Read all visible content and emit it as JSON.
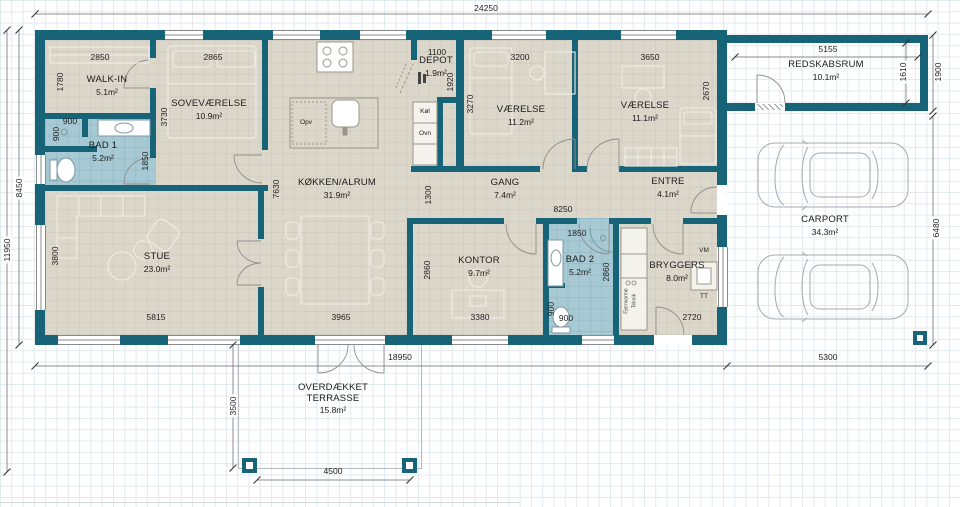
{
  "colors": {
    "wall": "#176478",
    "floor": "#dcd7cb",
    "bathroom_floor": "#a7c9d3",
    "grid": "#e2e9ee",
    "dimension_text": "#1f1f1f"
  },
  "rooms": [
    {
      "name": "WALK-IN",
      "area": "5.1m²",
      "x": 107,
      "y": 86,
      "w": 70
    },
    {
      "name": "SOVEVÆRELSE",
      "area": "10.9m²",
      "x": 209,
      "y": 110,
      "w": 96
    },
    {
      "name": "BAD 1",
      "area": "5.2m²",
      "x": 103,
      "y": 152,
      "w": 60
    },
    {
      "name": "KØKKEN/ALRUM",
      "area": "31.9m²",
      "x": 337,
      "y": 189,
      "w": 104
    },
    {
      "name": "DEPOT",
      "area": "1.9m²",
      "x": 436,
      "y": 67,
      "w": 52
    },
    {
      "name": "VÆRELSE",
      "area": "11.2m²",
      "x": 521,
      "y": 116,
      "w": 70
    },
    {
      "name": "VÆRELSE",
      "area": "11.1m²",
      "x": 645,
      "y": 112,
      "w": 70
    },
    {
      "name": "GANG",
      "area": "7.4m²",
      "x": 505,
      "y": 189,
      "w": 60
    },
    {
      "name": "ENTRE",
      "area": "4.1m²",
      "x": 668,
      "y": 188,
      "w": 60
    },
    {
      "name": "STUE",
      "area": "23.0m²",
      "x": 157,
      "y": 263,
      "w": 60
    },
    {
      "name": "KONTOR",
      "area": "9.7m²",
      "x": 479,
      "y": 267,
      "w": 60
    },
    {
      "name": "BAD 2",
      "area": "5.2m²",
      "x": 580,
      "y": 266,
      "w": 56
    },
    {
      "name": "BRYGGERS",
      "area": "8.0m²",
      "x": 677,
      "y": 272,
      "w": 70
    },
    {
      "name": "REDSKABSRUM",
      "area": "10.1m²",
      "x": 826,
      "y": 71,
      "w": 110
    },
    {
      "name": "CARPORT",
      "area": "34.3m²",
      "x": 825,
      "y": 226,
      "w": 80
    },
    {
      "name": "OVERDÆKKET TERRASSE",
      "area": "15.8m²",
      "x": 333,
      "y": 399,
      "w": 92
    }
  ],
  "dims": [
    {
      "t": "24250",
      "x": 486,
      "y": 8
    },
    {
      "t": "18950",
      "x": 400,
      "y": 357
    },
    {
      "t": "5300",
      "x": 828,
      "y": 357
    },
    {
      "t": "11950",
      "x": 7,
      "y": 250,
      "v": 1,
      "bg": 1
    },
    {
      "t": "8450",
      "x": 19,
      "y": 188,
      "v": 1,
      "bg": 1
    },
    {
      "t": "3500",
      "x": 233,
      "y": 406,
      "v": 1,
      "bg": 1
    },
    {
      "t": "4500",
      "x": 333,
      "y": 471
    },
    {
      "t": "1900",
      "x": 938,
      "y": 72,
      "v": 1,
      "bg": 1
    },
    {
      "t": "6480",
      "x": 936,
      "y": 228,
      "v": 1,
      "bg": 1
    },
    {
      "t": "5155",
      "x": 828,
      "y": 49
    },
    {
      "t": "1610",
      "x": 903,
      "y": 72,
      "v": 1,
      "bg": 1
    },
    {
      "t": "2850",
      "x": 100,
      "y": 57
    },
    {
      "t": "2865",
      "x": 213,
      "y": 57
    },
    {
      "t": "1100",
      "x": 437,
      "y": 52
    },
    {
      "t": "3200",
      "x": 520,
      "y": 57
    },
    {
      "t": "3650",
      "x": 650,
      "y": 57
    },
    {
      "t": "1780",
      "x": 60,
      "y": 82,
      "v": 1
    },
    {
      "t": "3730",
      "x": 164,
      "y": 117,
      "v": 1
    },
    {
      "t": "900",
      "x": 70,
      "y": 121
    },
    {
      "t": "900",
      "x": 56,
      "y": 134,
      "v": 1
    },
    {
      "t": "1850",
      "x": 145,
      "y": 161,
      "v": 1
    },
    {
      "t": "7630",
      "x": 276,
      "y": 189,
      "v": 1
    },
    {
      "t": "1920",
      "x": 450,
      "y": 82,
      "v": 1
    },
    {
      "t": "3270",
      "x": 470,
      "y": 104,
      "v": 1
    },
    {
      "t": "2670",
      "x": 706,
      "y": 91,
      "v": 1
    },
    {
      "t": "1300",
      "x": 428,
      "y": 195,
      "v": 1
    },
    {
      "t": "8250",
      "x": 563,
      "y": 209
    },
    {
      "t": "3800",
      "x": 55,
      "y": 256,
      "v": 1
    },
    {
      "t": "5815",
      "x": 156,
      "y": 317
    },
    {
      "t": "3965",
      "x": 341,
      "y": 317
    },
    {
      "t": "1850",
      "x": 577,
      "y": 233
    },
    {
      "t": "2860",
      "x": 427,
      "y": 270,
      "v": 1
    },
    {
      "t": "2860",
      "x": 606,
      "y": 272,
      "v": 1
    },
    {
      "t": "3380",
      "x": 480,
      "y": 317
    },
    {
      "t": "900",
      "x": 551,
      "y": 309,
      "v": 1
    },
    {
      "t": "900",
      "x": 566,
      "y": 318
    },
    {
      "t": "2720",
      "x": 692,
      "y": 317
    }
  ],
  "fixtures": [
    {
      "t": "Opv",
      "x": 306,
      "y": 123
    },
    {
      "t": "Køl",
      "x": 425,
      "y": 112
    },
    {
      "t": "Ovn",
      "x": 425,
      "y": 134
    },
    {
      "t": "VM",
      "x": 704,
      "y": 251
    },
    {
      "t": "TT",
      "x": 704,
      "y": 297
    },
    {
      "t": "Fjernvarme",
      "x": 627,
      "y": 301,
      "v": 1,
      "sm": 1
    },
    {
      "t": "Teknik",
      "x": 635,
      "y": 301,
      "v": 1,
      "sm": 1
    }
  ]
}
